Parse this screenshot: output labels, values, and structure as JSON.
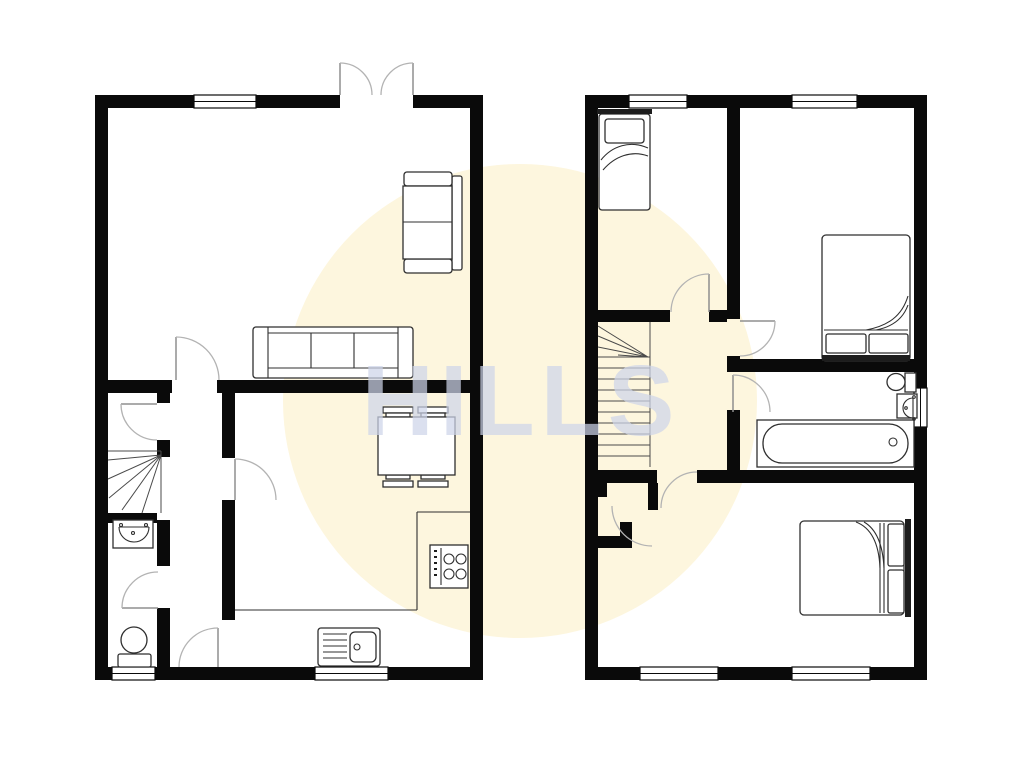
{
  "watermark": {
    "text": "HILLS"
  },
  "canvas": {
    "width": 1024,
    "height": 778
  },
  "colors": {
    "background": "#ffffff",
    "wall": "#0a0a0a",
    "door-arc": "#b3b3b3",
    "door-leaf": "#8f8f8f",
    "furniture-line": "#2f2f2f",
    "stair-line": "#4a4a4a",
    "headboard": "#1d1d1d",
    "window-fill": "#ffffff",
    "watermark-circle": "#fdf6de",
    "watermark-text": "rgba(205,212,233,0.72)"
  },
  "plans": {
    "left": {
      "id": "ground-floor",
      "feature_icons": [
        "window-icon",
        "french-doors-icon",
        "two-seat-sofa-icon",
        "three-seat-sofa-icon",
        "door-arc-icon",
        "staircase-icon",
        "wash-basin-icon",
        "toilet-icon",
        "dining-table-icon",
        "chair-icon",
        "kitchen-counter-icon",
        "hob-icon",
        "kitchen-sink-icon"
      ]
    },
    "right": {
      "id": "first-floor",
      "feature_icons": [
        "window-icon",
        "single-bed-icon",
        "double-bed-icon",
        "door-arc-icon",
        "staircase-icon",
        "cupboard-icon",
        "bath-icon",
        "toilet-icon",
        "wash-basin-icon"
      ]
    }
  }
}
